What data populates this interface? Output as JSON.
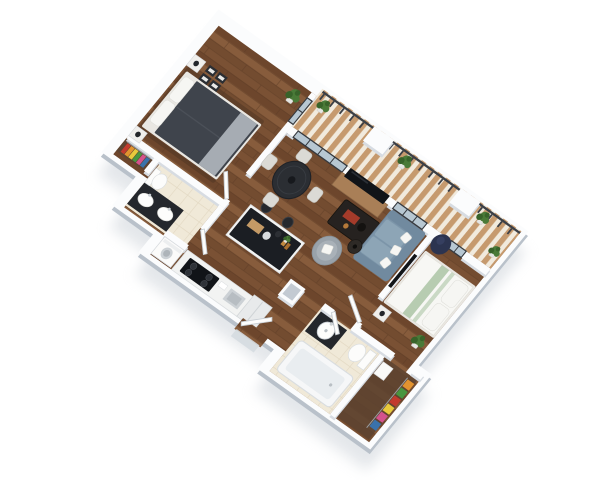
{
  "image": {
    "type": "3d-floor-plan-render",
    "view": "rotated isometric top-down",
    "unit": "Two-bedroom two-bathroom apartment 3D floor plan with wrap balcony",
    "background": "#ffffff"
  },
  "colors": {
    "bg": "#ffffff",
    "outerWall": "#b9c1ca",
    "wallTop": "#fbfcfd",
    "wallShade": "#d7dce2",
    "shadow": "#c9cfd6",
    "wood1": "#7a5134",
    "wood2": "#6d462c",
    "wood3": "#875c3c",
    "wood4": "#734c30",
    "seam": "#5a3a24",
    "rug": "#4e3322",
    "tile": "#f0e9d8",
    "tileLine": "#e2d8c2",
    "deckA": "#c69a6e",
    "deckB": "#f1eadd",
    "rail": "#3b3f46",
    "glass": "#b7c7d2",
    "frame": "#35393f",
    "bedDark": "#3f444c",
    "throwGray": "#a6acb3",
    "bedFrame": "#e9e7e2",
    "linen": "#f7f7f4",
    "sage": "#b7ccb1",
    "sofa": "#7b93a8",
    "sofaArm": "#718a9f",
    "cushion": "#8da5b6",
    "charcoal": "#24272c",
    "consoleWood": "#a97f57",
    "chairLight": "#dbdad5",
    "armGray": "#99a2aa",
    "bean": "#2c3450",
    "accentRed": "#a43b2a",
    "amber": "#c08940",
    "plant": "#4a7a38",
    "plantDark": "#38632a",
    "pot": "#e6e6e3",
    "steel": "#ccd1d5",
    "appliance": "#e8eaeb",
    "closetBrown": "#5d4330",
    "black": "#111418"
  },
  "clothes_palette": [
    "#c23b2e",
    "#e2932f",
    "#e8c93c",
    "#48963f",
    "#d4538c",
    "#3a72ab"
  ],
  "rooms": [
    {
      "id": "bedroom-1",
      "items": [
        "double-bed",
        "dark-duvet",
        "white-pillows",
        "gray-throw",
        "nightstands",
        "table-lamps",
        "gallery-frames",
        "area-rug",
        "potted-plant",
        "balcony-glass-door"
      ]
    },
    {
      "id": "walk-in-closet-1",
      "items": [
        "hanging-clothes",
        "clothes-rod"
      ]
    },
    {
      "id": "bathroom-1",
      "items": [
        "double-sink-vanity",
        "toilet",
        "cream-tile-floor"
      ]
    },
    {
      "id": "laundry-nook",
      "items": [
        "washer"
      ]
    },
    {
      "id": "kitchen",
      "items": [
        "counter-run",
        "black-cooktop",
        "sink",
        "fridge",
        "island-black-top",
        "bar-stools",
        "cutting-board",
        "bottles"
      ]
    },
    {
      "id": "dining",
      "items": [
        "round-dark-table",
        "four-upholstered-chairs",
        "centerpiece"
      ]
    },
    {
      "id": "living",
      "items": [
        "tv-console",
        "flat-tv",
        "slate-sofa",
        "white-throw-pillows",
        "dark-coffee-table",
        "gray-armchair",
        "side-table",
        "navy-bean-bag"
      ]
    },
    {
      "id": "bedroom-2",
      "items": [
        "double-bed",
        "sage-striped-duvet",
        "white-pillows",
        "wall-tv",
        "nightstand",
        "potted-plant"
      ]
    },
    {
      "id": "walk-in-closet-2",
      "items": [
        "hanging-clothes",
        "shelf"
      ]
    },
    {
      "id": "bathroom-2",
      "items": [
        "dark-vanity",
        "round-sink",
        "toilet",
        "bathtub",
        "cream-tile-floor"
      ]
    },
    {
      "id": "balcony",
      "items": [
        "striped-decking",
        "dark-railing",
        "railing-posts",
        "pier-columns",
        "potted-plants"
      ]
    },
    {
      "id": "entry",
      "items": [
        "open-door",
        "gray-top-column",
        "stoop"
      ]
    }
  ]
}
